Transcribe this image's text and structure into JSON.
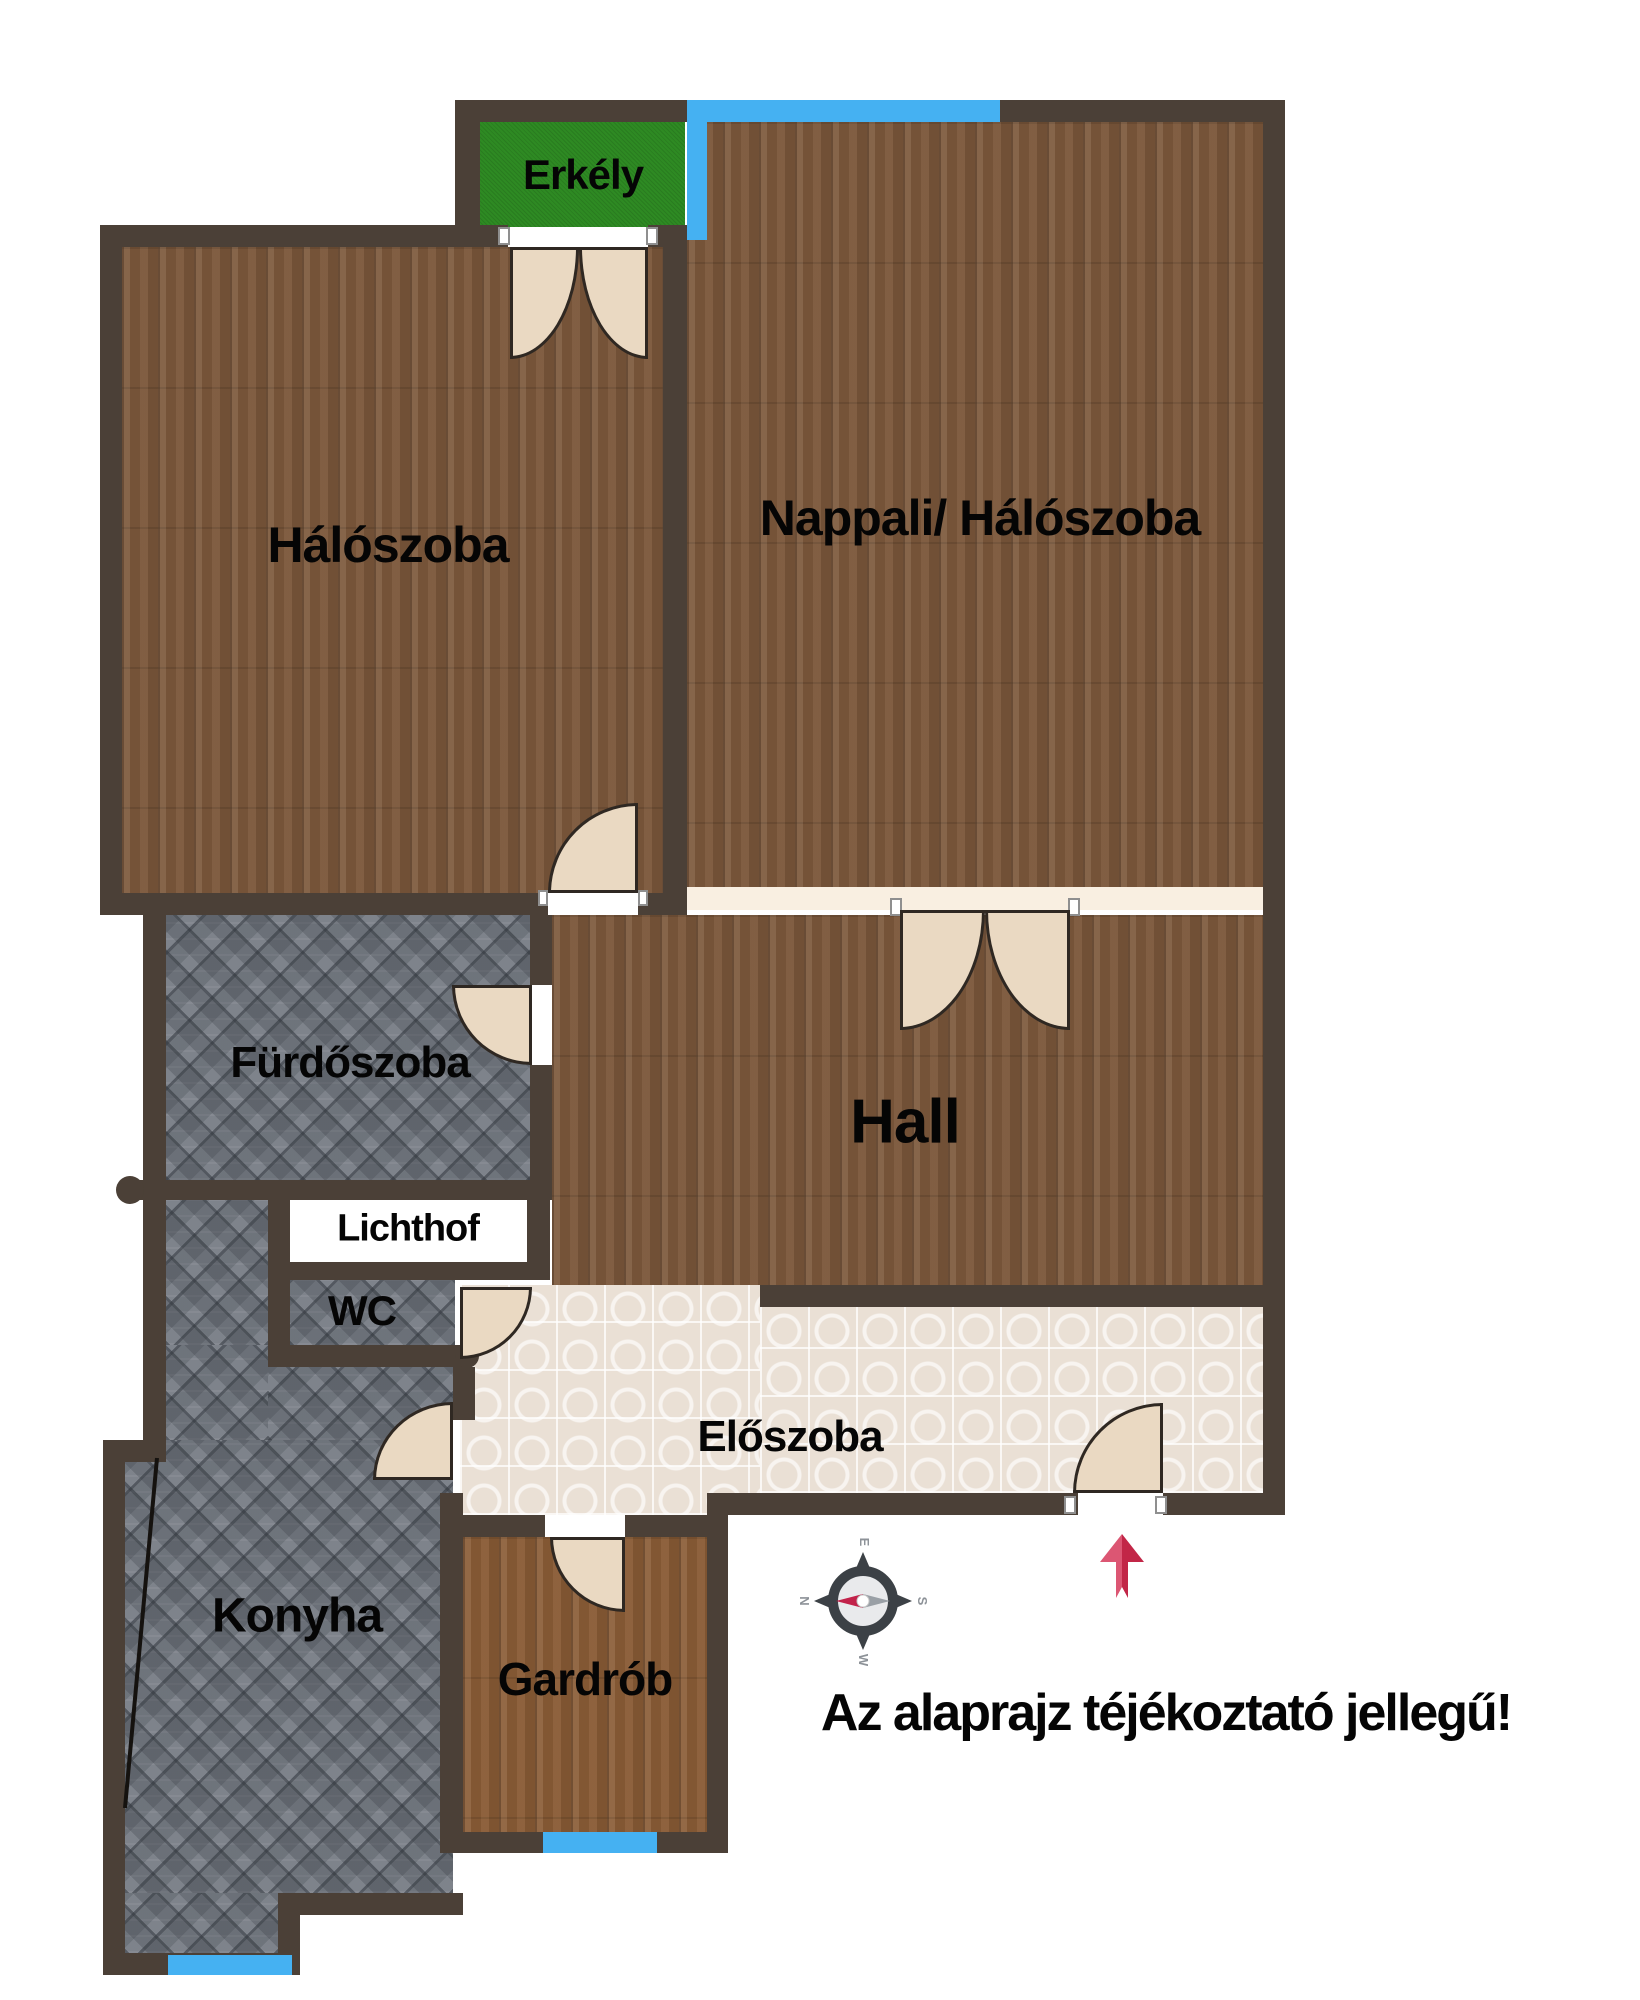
{
  "rooms": {
    "erkely": {
      "label": "Erkély"
    },
    "haloszoba": {
      "label": "Hálószoba"
    },
    "nappali": {
      "label": "Nappali/ Hálószoba"
    },
    "furdoszoba": {
      "label": "Fürdőszoba"
    },
    "lichthof": {
      "label": "Lichthof"
    },
    "wc": {
      "label": "WC"
    },
    "hall": {
      "label": "Hall"
    },
    "eloszoba": {
      "label": "Előszoba"
    },
    "gardrob": {
      "label": "Gardrób"
    },
    "konyha": {
      "label": "Konyha"
    }
  },
  "disclaimer": "Az alaprajz téjékoztató jellegű!",
  "compass": {
    "north": "N",
    "east": "E",
    "south": "S",
    "west": "W"
  },
  "colors": {
    "wall": "#4b4037",
    "wood": "#7c583b",
    "wood_light": "#8a5c36",
    "tile_gray": "#7e838b",
    "tile_light": "#eae0d5",
    "balcony_green": "#2e8a23",
    "window_blue": "#45b1f2",
    "opening_cream": "#f9efe1",
    "door_fill": "#ead9c2",
    "door_border": "#2f2822",
    "arrow_red": "#c22647",
    "arrow_red_light": "#dc5673",
    "compass_dark": "#3c4146"
  }
}
